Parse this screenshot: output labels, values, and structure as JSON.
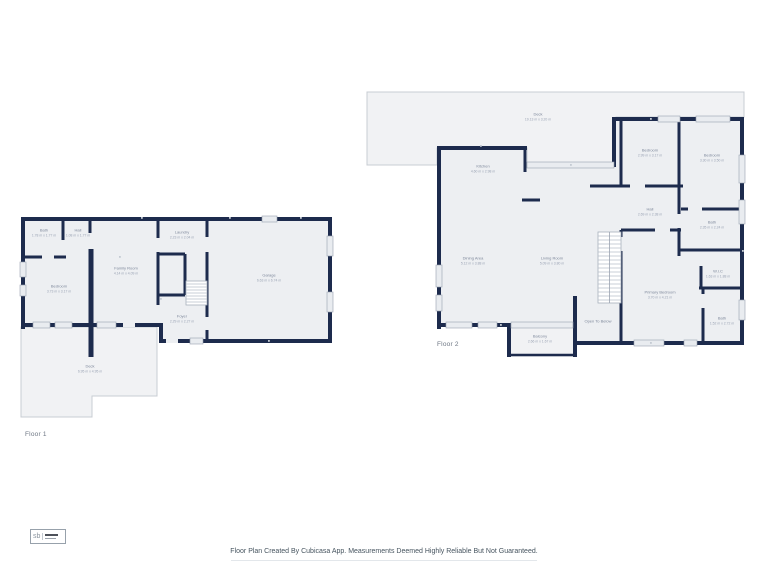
{
  "colors": {
    "wall": "#1d2b4d",
    "floor_fill": "#edeff2",
    "deck_fill": "#f1f2f4",
    "deck_stroke": "#c8cdd3",
    "window_fill": "#e9ecf0",
    "window_stroke": "#97a1b0",
    "room_name_color": "#7e889b",
    "room_dims_color": "#9aa3b4"
  },
  "floors": [
    {
      "label": "Floor 1",
      "rooms": [
        {
          "name": "Bath",
          "dims": "1.78 m x 1.77 m",
          "x": 44,
          "y": 233
        },
        {
          "name": "Hall",
          "dims": "1.08 m x 1.77 m",
          "x": 78,
          "y": 233
        },
        {
          "name": "Laundry",
          "dims": "2.23 m x 2.04 m",
          "x": 182,
          "y": 235
        },
        {
          "name": "Family Room",
          "dims": "4.14 m x 4.09 m",
          "x": 126,
          "y": 271
        },
        {
          "name": "Bedroom",
          "dims": "3.73 m x 3.17 m",
          "x": 59,
          "y": 289
        },
        {
          "name": "Foyer",
          "dims": "2.29 m x 2.27 m",
          "x": 182,
          "y": 319
        },
        {
          "name": "Garage",
          "dims": "6.63 m x 6.74 m",
          "x": 269,
          "y": 278
        },
        {
          "name": "Deck",
          "dims": "6.95 m x 4.95 m",
          "x": 90,
          "y": 369
        }
      ]
    },
    {
      "label": "Floor 2",
      "rooms": [
        {
          "name": "Deck",
          "dims": "19.13 m x 3.20 m",
          "x": 538,
          "y": 117
        },
        {
          "name": "Kitchen",
          "dims": "4.60 m x 2.98 m",
          "x": 483,
          "y": 169
        },
        {
          "name": "Bedroom",
          "dims": "2.99 m x 3.17 m",
          "x": 650,
          "y": 153
        },
        {
          "name": "Bedroom",
          "dims": "3.30 m x 3.50 m",
          "x": 712,
          "y": 158
        },
        {
          "name": "Hall",
          "dims": "2.69 m x 2.38 m",
          "x": 650,
          "y": 212
        },
        {
          "name": "Bath",
          "dims": "2.35 m x 2.24 m",
          "x": 712,
          "y": 225
        },
        {
          "name": "Dining Area",
          "dims": "5.12 m x 3.88 m",
          "x": 473,
          "y": 261
        },
        {
          "name": "Living Room",
          "dims": "5.09 m x 3.80 m",
          "x": 552,
          "y": 261
        },
        {
          "name": "W.I.C",
          "dims": "1.63 m x 1.88 m",
          "x": 718,
          "y": 274
        },
        {
          "name": "Primary Bedroom",
          "dims": "3.70 m x 4.21 m",
          "x": 660,
          "y": 295
        },
        {
          "name": "Open To Below",
          "dims": "",
          "x": 598,
          "y": 324
        },
        {
          "name": "Bath",
          "dims": "1.52 m x 2.72 m",
          "x": 722,
          "y": 321
        },
        {
          "name": "Balcony",
          "dims": "2.66 m x 1.67 m",
          "x": 540,
          "y": 339
        }
      ]
    }
  ],
  "footer": {
    "disclaimer": "Floor Plan Created By Cubicasa App. Measurements Deemed Highly Reliable But Not Guaranteed."
  },
  "logo": {
    "text": "sb"
  }
}
